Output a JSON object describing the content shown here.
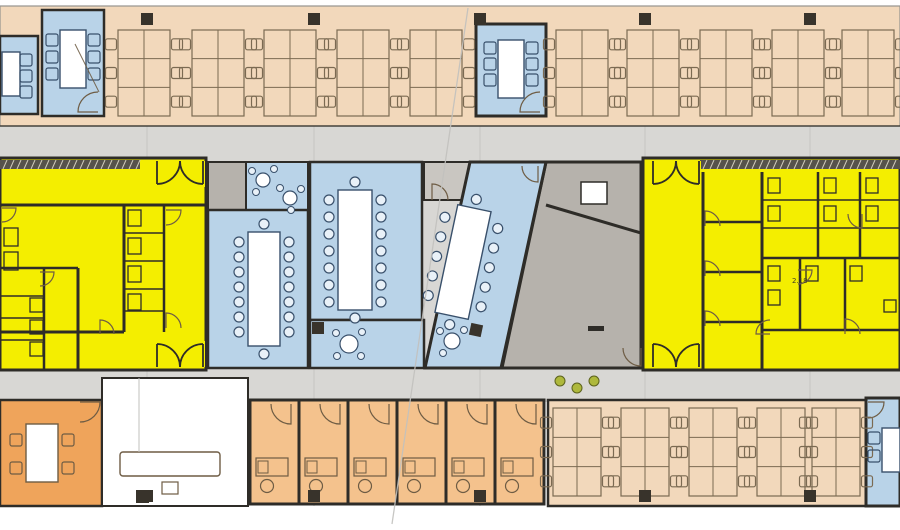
{
  "palette": {
    "wall": "#2e2c28",
    "furn": "#6e5c44",
    "blueFurn": "#39506b",
    "chairBlue": "#e9f1f8",
    "peach": "#f2d8bb",
    "peachLine": "#7b6a52",
    "yellow": "#f4ee00",
    "blue": "#b9d3e8",
    "orange": "#efa45b",
    "orangeLight": "#f4c28d",
    "grayCorridor": "#d8d7d4",
    "grayRoom": "#b6b2ac",
    "grayRoomLight": "#c9c6c1",
    "white": "#ffffff",
    "column": "#38332b",
    "hatch": "#56524b",
    "faint": "#c2c1be",
    "green": "#aeb83c",
    "label": "#403d28",
    "bandEdge": "#96948e"
  },
  "canvas": {
    "w": 900,
    "h": 530
  },
  "corridor": {
    "x": 0,
    "y": 126,
    "w": 900,
    "h": 276
  },
  "grid_columns": {
    "xs": [
      141,
      308,
      474,
      639,
      804
    ],
    "rows": [
      13,
      490
    ],
    "size": 12,
    "extra": [
      [
        312,
        322
      ]
    ]
  },
  "rooms": [
    {
      "id": "open-office-top",
      "shape": "rect",
      "x": 0,
      "y": 6,
      "w": 900,
      "h": 120,
      "fill": "peach",
      "stroke": "bandEdge",
      "sw": 1.2
    },
    {
      "id": "open-office-bottom",
      "shape": "rect",
      "x": 548,
      "y": 400,
      "w": 318,
      "h": 106,
      "fill": "peach",
      "stroke": "wall",
      "sw": 2.5
    },
    {
      "id": "orange-meeting-room",
      "shape": "rect",
      "x": 0,
      "y": 400,
      "w": 102,
      "h": 106,
      "fill": "orange",
      "stroke": "wall",
      "sw": 2.5
    },
    {
      "id": "lobby",
      "shape": "rect",
      "x": 102,
      "y": 378,
      "w": 146,
      "h": 128,
      "fill": "white",
      "stroke": "wall",
      "sw": 2
    },
    {
      "id": "office-cell-1",
      "shape": "rect",
      "x": 250,
      "y": 400,
      "w": 49,
      "h": 104,
      "fill": "orangeLight",
      "stroke": "wall",
      "sw": 3
    },
    {
      "id": "office-cell-2",
      "shape": "rect",
      "x": 299,
      "y": 400,
      "w": 49,
      "h": 104,
      "fill": "orangeLight",
      "stroke": "wall",
      "sw": 3
    },
    {
      "id": "office-cell-3",
      "shape": "rect",
      "x": 348,
      "y": 400,
      "w": 49,
      "h": 104,
      "fill": "orangeLight",
      "stroke": "wall",
      "sw": 3
    },
    {
      "id": "office-cell-4",
      "shape": "rect",
      "x": 397,
      "y": 400,
      "w": 49,
      "h": 104,
      "fill": "orangeLight",
      "stroke": "wall",
      "sw": 3
    },
    {
      "id": "office-cell-5",
      "shape": "rect",
      "x": 446,
      "y": 400,
      "w": 49,
      "h": 104,
      "fill": "orangeLight",
      "stroke": "wall",
      "sw": 3
    },
    {
      "id": "office-cell-6",
      "shape": "rect",
      "x": 495,
      "y": 400,
      "w": 49,
      "h": 104,
      "fill": "orangeLight",
      "stroke": "wall",
      "sw": 3
    },
    {
      "id": "core-zone-left",
      "shape": "rect",
      "x": 0,
      "y": 158,
      "w": 206,
      "h": 212,
      "fill": "yellow",
      "stroke": "wall",
      "sw": 3
    },
    {
      "id": "core-zone-right",
      "shape": "rect",
      "x": 643,
      "y": 158,
      "w": 257,
      "h": 212,
      "fill": "yellow",
      "stroke": "wall",
      "sw": 3
    },
    {
      "id": "gray-store-room",
      "shape": "rect",
      "x": 208,
      "y": 162,
      "w": 38,
      "h": 48,
      "fill": "grayRoom",
      "stroke": "wall",
      "sw": 2
    },
    {
      "id": "blue-lounge",
      "shape": "rect",
      "x": 246,
      "y": 162,
      "w": 62,
      "h": 48,
      "fill": "blue",
      "stroke": "wall",
      "sw": 2
    },
    {
      "id": "conference-room-1",
      "shape": "rect",
      "x": 208,
      "y": 210,
      "w": 100,
      "h": 158,
      "fill": "blue",
      "stroke": "wall",
      "sw": 2.5
    },
    {
      "id": "conference-room-2",
      "shape": "rect",
      "x": 310,
      "y": 162,
      "w": 112,
      "h": 158,
      "fill": "blue",
      "stroke": "wall",
      "sw": 2.5
    },
    {
      "id": "blue-break-room",
      "shape": "rect",
      "x": 310,
      "y": 320,
      "w": 114,
      "h": 48,
      "fill": "blue",
      "stroke": "wall",
      "sw": 2.5
    },
    {
      "id": "gray-anteroom",
      "shape": "rect",
      "x": 424,
      "y": 162,
      "w": 46,
      "h": 38,
      "fill": "grayRoomLight",
      "stroke": "wall",
      "sw": 2
    },
    {
      "id": "gray-hall",
      "shape": "polygon",
      "points": "546,162 641,162 641,368 502,368",
      "fill": "grayRoom",
      "stroke": "wall",
      "sw": 3
    },
    {
      "id": "skewed-meeting-room",
      "shape": "polygon",
      "points": "470,162 546,162 501,368 425,368",
      "fill": "blue",
      "stroke": "wall",
      "sw": 3
    },
    {
      "id": "blue-room-topleft-a",
      "shape": "rect",
      "x": 0,
      "y": 36,
      "w": 38,
      "h": 78,
      "fill": "blue",
      "stroke": "wall",
      "sw": 2.5
    },
    {
      "id": "blue-room-topleft-b",
      "shape": "rect",
      "x": 42,
      "y": 10,
      "w": 62,
      "h": 106,
      "fill": "blue",
      "stroke": "wall",
      "sw": 2.5
    },
    {
      "id": "blue-room-topcenter",
      "shape": "rect",
      "x": 476,
      "y": 24,
      "w": 70,
      "h": 92,
      "fill": "blue",
      "stroke": "wall",
      "sw": 3
    },
    {
      "id": "blue-room-bottomright",
      "shape": "rect",
      "x": 866,
      "y": 398,
      "w": 34,
      "h": 108,
      "fill": "blue",
      "stroke": "wall",
      "sw": 3
    }
  ],
  "hatch_strips": [
    {
      "x": 0,
      "y": 160,
      "w": 140,
      "h": 9
    },
    {
      "x": 700,
      "y": 160,
      "w": 200,
      "h": 9
    }
  ],
  "walls": [
    [
      0,
      205,
      206,
      205,
      3
    ],
    [
      124,
      205,
      124,
      332,
      3
    ],
    [
      164,
      205,
      164,
      332,
      2.5
    ],
    [
      0,
      268,
      78,
      268,
      2.5
    ],
    [
      78,
      268,
      78,
      370,
      3
    ],
    [
      0,
      332,
      124,
      332,
      3
    ],
    [
      44,
      268,
      44,
      370,
      2.5
    ],
    [
      124,
      233,
      164,
      233,
      1.5
    ],
    [
      124,
      261,
      164,
      261,
      1.5
    ],
    [
      124,
      289,
      164,
      289,
      1.5
    ],
    [
      124,
      311,
      164,
      311,
      1.5
    ],
    [
      0,
      296,
      44,
      296,
      1.5
    ],
    [
      0,
      318,
      44,
      318,
      1.5
    ],
    [
      0,
      340,
      44,
      340,
      1.5
    ],
    [
      703,
      172,
      703,
      370,
      3
    ],
    [
      703,
      222,
      762,
      222,
      2.5
    ],
    [
      703,
      272,
      762,
      272,
      2.5
    ],
    [
      703,
      322,
      762,
      322,
      2.5
    ],
    [
      762,
      172,
      762,
      370,
      3
    ],
    [
      762,
      258,
      900,
      258,
      2.5
    ],
    [
      818,
      172,
      818,
      258,
      2.5
    ],
    [
      860,
      172,
      860,
      258,
      2.5
    ],
    [
      762,
      200,
      900,
      200,
      1.5
    ],
    [
      762,
      228,
      900,
      228,
      1.5
    ],
    [
      800,
      258,
      800,
      330,
      2.5
    ],
    [
      845,
      258,
      845,
      330,
      2.5
    ],
    [
      762,
      330,
      900,
      330,
      2.5
    ],
    [
      546,
      205,
      641,
      233,
      3
    ],
    [
      0,
      126,
      900,
      126,
      1.2
    ]
  ],
  "fixtures": [
    [
      128,
      210,
      13,
      16
    ],
    [
      128,
      238,
      13,
      16
    ],
    [
      128,
      266,
      13,
      16
    ],
    [
      128,
      294,
      13,
      16
    ],
    [
      30,
      298,
      13,
      14
    ],
    [
      30,
      320,
      13,
      14
    ],
    [
      30,
      342,
      13,
      14
    ],
    [
      4,
      228,
      14,
      18
    ],
    [
      4,
      252,
      14,
      18
    ],
    [
      768,
      178,
      12,
      15
    ],
    [
      768,
      206,
      12,
      15
    ],
    [
      824,
      178,
      12,
      15
    ],
    [
      824,
      206,
      12,
      15
    ],
    [
      866,
      178,
      12,
      15
    ],
    [
      866,
      206,
      12,
      15
    ],
    [
      768,
      266,
      12,
      15
    ],
    [
      768,
      290,
      12,
      15
    ],
    [
      806,
      266,
      12,
      15
    ],
    [
      850,
      266,
      12,
      15
    ],
    [
      884,
      300,
      12,
      12
    ]
  ],
  "gray_hall_extras": {
    "table": [
      581,
      182,
      26,
      22
    ],
    "dash": [
      588,
      326,
      16,
      5
    ]
  },
  "door_arcs": [
    [
      98,
      112,
      20,
      "nw"
    ],
    [
      540,
      112,
      20,
      "nw"
    ],
    [
      432,
      200,
      16,
      "ne"
    ],
    [
      291,
      404,
      20,
      "sw"
    ],
    [
      340,
      404,
      20,
      "sw"
    ],
    [
      389,
      404,
      20,
      "sw"
    ],
    [
      438,
      404,
      20,
      "sw"
    ],
    [
      487,
      404,
      20,
      "sw"
    ],
    [
      536,
      404,
      20,
      "sw"
    ],
    [
      80,
      402,
      20,
      "se"
    ],
    [
      641,
      348,
      18,
      "sw"
    ],
    [
      166,
      210,
      15,
      "se"
    ],
    [
      166,
      328,
      15,
      "ne"
    ],
    [
      40,
      272,
      14,
      "se"
    ],
    [
      100,
      334,
      14,
      "ne"
    ],
    [
      2,
      208,
      14,
      "se"
    ],
    [
      705,
      226,
      15,
      "ne"
    ],
    [
      705,
      276,
      15,
      "ne"
    ],
    [
      705,
      326,
      15,
      "ne"
    ],
    [
      862,
      214,
      14,
      "sw"
    ],
    [
      798,
      270,
      14,
      "se"
    ],
    [
      845,
      334,
      15,
      "ne"
    ],
    [
      770,
      334,
      14,
      "nw"
    ],
    [
      538,
      166,
      16,
      "sw"
    ],
    [
      868,
      402,
      16,
      "se"
    ]
  ],
  "double_doors": [
    {
      "cx": 180,
      "y": 161,
      "w": 46,
      "dir": 1
    },
    {
      "cx": 180,
      "y": 367,
      "w": 46,
      "dir": -1
    },
    {
      "cx": 676,
      "y": 161,
      "w": 46,
      "dir": 1
    },
    {
      "cx": 676,
      "y": 367,
      "w": 46,
      "dir": -1
    }
  ],
  "desk_clusters": {
    "top": {
      "y": 30,
      "w": 52,
      "h": 86,
      "xs": [
        118,
        192,
        264,
        337,
        410,
        556,
        627,
        700,
        772,
        842
      ]
    },
    "bottom": {
      "y": 408,
      "w": 48,
      "h": 88,
      "xs": [
        553,
        621,
        689,
        757,
        812
      ]
    }
  },
  "tables": [
    {
      "id": "table-topleft-a",
      "x": 2,
      "y": 52,
      "w": 18,
      "h": 44,
      "pal": "blue",
      "squares": [
        [
          26,
          60
        ],
        [
          26,
          76
        ],
        [
          26,
          92
        ]
      ]
    },
    {
      "id": "table-topleft-b",
      "x": 60,
      "y": 30,
      "w": 26,
      "h": 58,
      "pal": "blue",
      "squares": [
        [
          52,
          40
        ],
        [
          52,
          57
        ],
        [
          52,
          74
        ],
        [
          94,
          40
        ],
        [
          94,
          57
        ],
        [
          94,
          74
        ]
      ]
    },
    {
      "id": "table-topcenter",
      "x": 498,
      "y": 40,
      "w": 26,
      "h": 58,
      "pal": "blue",
      "squares": [
        [
          490,
          48
        ],
        [
          490,
          64
        ],
        [
          490,
          80
        ],
        [
          532,
          48
        ],
        [
          532,
          64
        ],
        [
          532,
          80
        ]
      ]
    },
    {
      "id": "conference-table-1",
      "x": 248,
      "y": 232,
      "w": 32,
      "h": 114,
      "pal": "blue",
      "rounds": [
        [
          239,
          242
        ],
        [
          239,
          257
        ],
        [
          239,
          272
        ],
        [
          239,
          287
        ],
        [
          239,
          302
        ],
        [
          239,
          317
        ],
        [
          239,
          332
        ],
        [
          289,
          242
        ],
        [
          289,
          257
        ],
        [
          289,
          272
        ],
        [
          289,
          287
        ],
        [
          289,
          302
        ],
        [
          289,
          317
        ],
        [
          289,
          332
        ],
        [
          264,
          224
        ],
        [
          264,
          354
        ]
      ]
    },
    {
      "id": "conference-table-2",
      "x": 338,
      "y": 190,
      "w": 34,
      "h": 120,
      "pal": "blue",
      "rounds": [
        [
          329,
          200
        ],
        [
          329,
          217
        ],
        [
          329,
          234
        ],
        [
          329,
          251
        ],
        [
          329,
          268
        ],
        [
          329,
          285
        ],
        [
          329,
          302
        ],
        [
          381,
          200
        ],
        [
          381,
          217
        ],
        [
          381,
          234
        ],
        [
          381,
          251
        ],
        [
          381,
          268
        ],
        [
          381,
          285
        ],
        [
          381,
          302
        ],
        [
          355,
          182
        ],
        [
          355,
          318
        ]
      ]
    },
    {
      "id": "skewed-table",
      "rot": {
        "cx": 463,
        "cy": 262,
        "deg": 12
      },
      "w": 34,
      "h": 110,
      "pal": "blue",
      "localRounds": [
        [
          -27,
          -40
        ],
        [
          -27,
          -20
        ],
        [
          -27,
          0
        ],
        [
          -27,
          20
        ],
        [
          -27,
          40
        ],
        [
          27,
          -40
        ],
        [
          27,
          -20
        ],
        [
          27,
          0
        ],
        [
          27,
          20
        ],
        [
          27,
          40
        ],
        [
          0,
          -64
        ],
        [
          0,
          64
        ]
      ]
    },
    {
      "id": "orange-table",
      "x": 26,
      "y": 424,
      "w": 32,
      "h": 58,
      "pal": "brown",
      "squares": [
        [
          16,
          440
        ],
        [
          16,
          468
        ],
        [
          68,
          440
        ],
        [
          68,
          468
        ]
      ]
    },
    {
      "id": "reception-counter",
      "x": 120,
      "y": 452,
      "w": 100,
      "h": 24,
      "pal": "brown",
      "rx": 3
    },
    {
      "id": "table-bottomright",
      "x": 882,
      "y": 428,
      "w": 18,
      "h": 44,
      "pal": "blue",
      "squares": [
        [
          874,
          438
        ],
        [
          874,
          456
        ]
      ]
    }
  ],
  "round_tables": [
    {
      "cx": 263,
      "cy": 180,
      "r": 7,
      "dots": [
        [
          252,
          171
        ],
        [
          274,
          169
        ],
        [
          256,
          192
        ]
      ]
    },
    {
      "cx": 290,
      "cy": 198,
      "r": 7,
      "dots": [
        [
          280,
          188
        ],
        [
          301,
          189
        ],
        [
          291,
          210
        ]
      ]
    },
    {
      "cx": 349,
      "cy": 344,
      "r": 9,
      "dots": [
        [
          336,
          333
        ],
        [
          362,
          332
        ],
        [
          337,
          356
        ],
        [
          361,
          356
        ]
      ]
    },
    {
      "cx": 452,
      "cy": 341,
      "r": 8,
      "dots": [
        [
          440,
          331
        ],
        [
          464,
          330
        ],
        [
          443,
          353
        ]
      ]
    }
  ],
  "office_desks": {
    "xs": [
      250,
      299,
      348,
      397,
      446,
      495
    ],
    "y": 400
  },
  "lobby_extras": {
    "stool": [
      162,
      482,
      16,
      12
    ],
    "column": [
      136,
      490,
      13,
      13
    ],
    "vline": [
      139,
      378,
      139,
      452
    ]
  },
  "skew_column": {
    "cx": 476,
    "cy": 330,
    "deg": 12,
    "size": 12
  },
  "plants": [
    [
      560,
      381
    ],
    [
      577,
      388
    ],
    [
      594,
      381
    ]
  ],
  "ref_lines": [
    [
      468,
      8,
      392,
      524,
      "faint",
      1.3
    ],
    [
      75,
      44,
      99,
      92,
      "furn",
      1
    ]
  ],
  "labels": [
    {
      "text": "2.18",
      "x": 792,
      "y": 283,
      "size": 7
    }
  ]
}
